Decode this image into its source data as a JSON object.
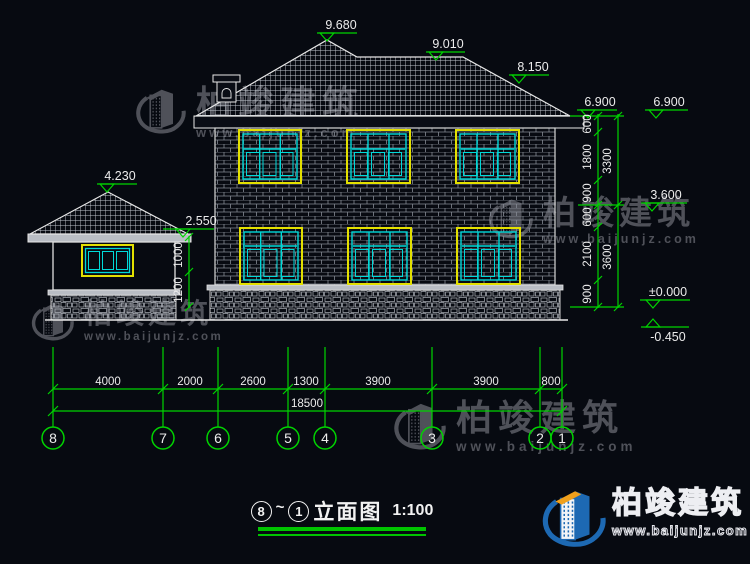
{
  "title": {
    "axis_start": "8",
    "tilde": "~",
    "axis_end": "1",
    "name": "立面图",
    "scale": "1:100"
  },
  "watermark": {
    "company": "柏竣建筑",
    "website": "www.baijunjz.com"
  },
  "logo": {
    "company": "柏竣建筑",
    "website": "www.baijunjz.com"
  },
  "grid_axes": [
    "8",
    "7",
    "6",
    "5",
    "4",
    "3",
    "2",
    "1"
  ],
  "elevations": {
    "ridge_main": "9.680",
    "ridge_mid": "9.010",
    "ridge_low": "8.150",
    "eave_main": "6.900",
    "eave_right": "6.900",
    "level_3600": "3.600",
    "ground_zero": "±0.000",
    "site_level": "-0.450",
    "garage_ridge": "4.230",
    "garage_eave": "2.550"
  },
  "dimensions": {
    "bottom": [
      "4000",
      "2000",
      "2600",
      "1300",
      "3900",
      "3900",
      "800"
    ],
    "bottom_total": "18500",
    "right_upper": [
      "600",
      "1800",
      "900"
    ],
    "right_upper_total": "3300",
    "right_lower": [
      "600",
      "2100",
      "900"
    ],
    "right_lower_total": "3600",
    "garage": [
      "1000",
      "1200"
    ]
  },
  "colors": {
    "background": "#070a11",
    "line_white": "#e8e8e8",
    "dimension_green": "#00d400",
    "window_frame_yellow": "#e3e000",
    "window_glass_cyan": "#00d9d9",
    "watermark_gray": "#55575f",
    "logo_blue": "#1d69b3",
    "logo_orange": "#f0a01c"
  }
}
